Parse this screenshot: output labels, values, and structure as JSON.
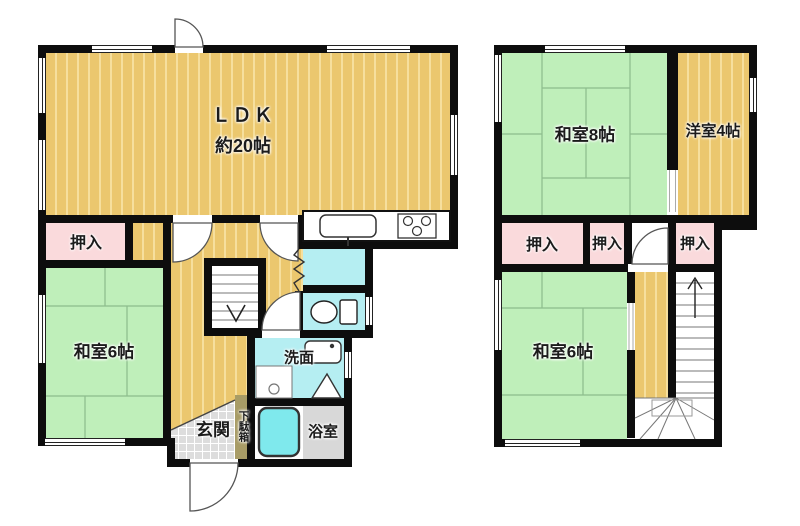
{
  "floor1": {
    "ldk_label": "ＬＤＫ",
    "ldk_size": "約20帖",
    "oshiire": "押入",
    "washitsu6": "和室6帖",
    "genkan": "玄関",
    "getabako": "下駄箱",
    "senmen": "洗面",
    "yokushitsu": "浴室"
  },
  "floor2": {
    "washitsu8": "和室8帖",
    "yoshitsu4": "洋室4帖",
    "oshiire_left": "押入",
    "oshiire_mid": "押入",
    "oshiire_right": "押入",
    "washitsu6": "和室6帖"
  },
  "colors": {
    "wall": "#0d0d0d",
    "wood": "#ebc76e",
    "wood_stripe": "#f6df9d",
    "tatami": "#bfefba",
    "tatami_line": "#8cbc8c",
    "closet_pink": "#fadadc",
    "water_cyan": "#b5eef2",
    "tub_cyan": "#7fe9ed",
    "bath_gray": "#d8d8d8",
    "tile_gray": "#dddddd",
    "getabako_olive": "#a89c66"
  }
}
